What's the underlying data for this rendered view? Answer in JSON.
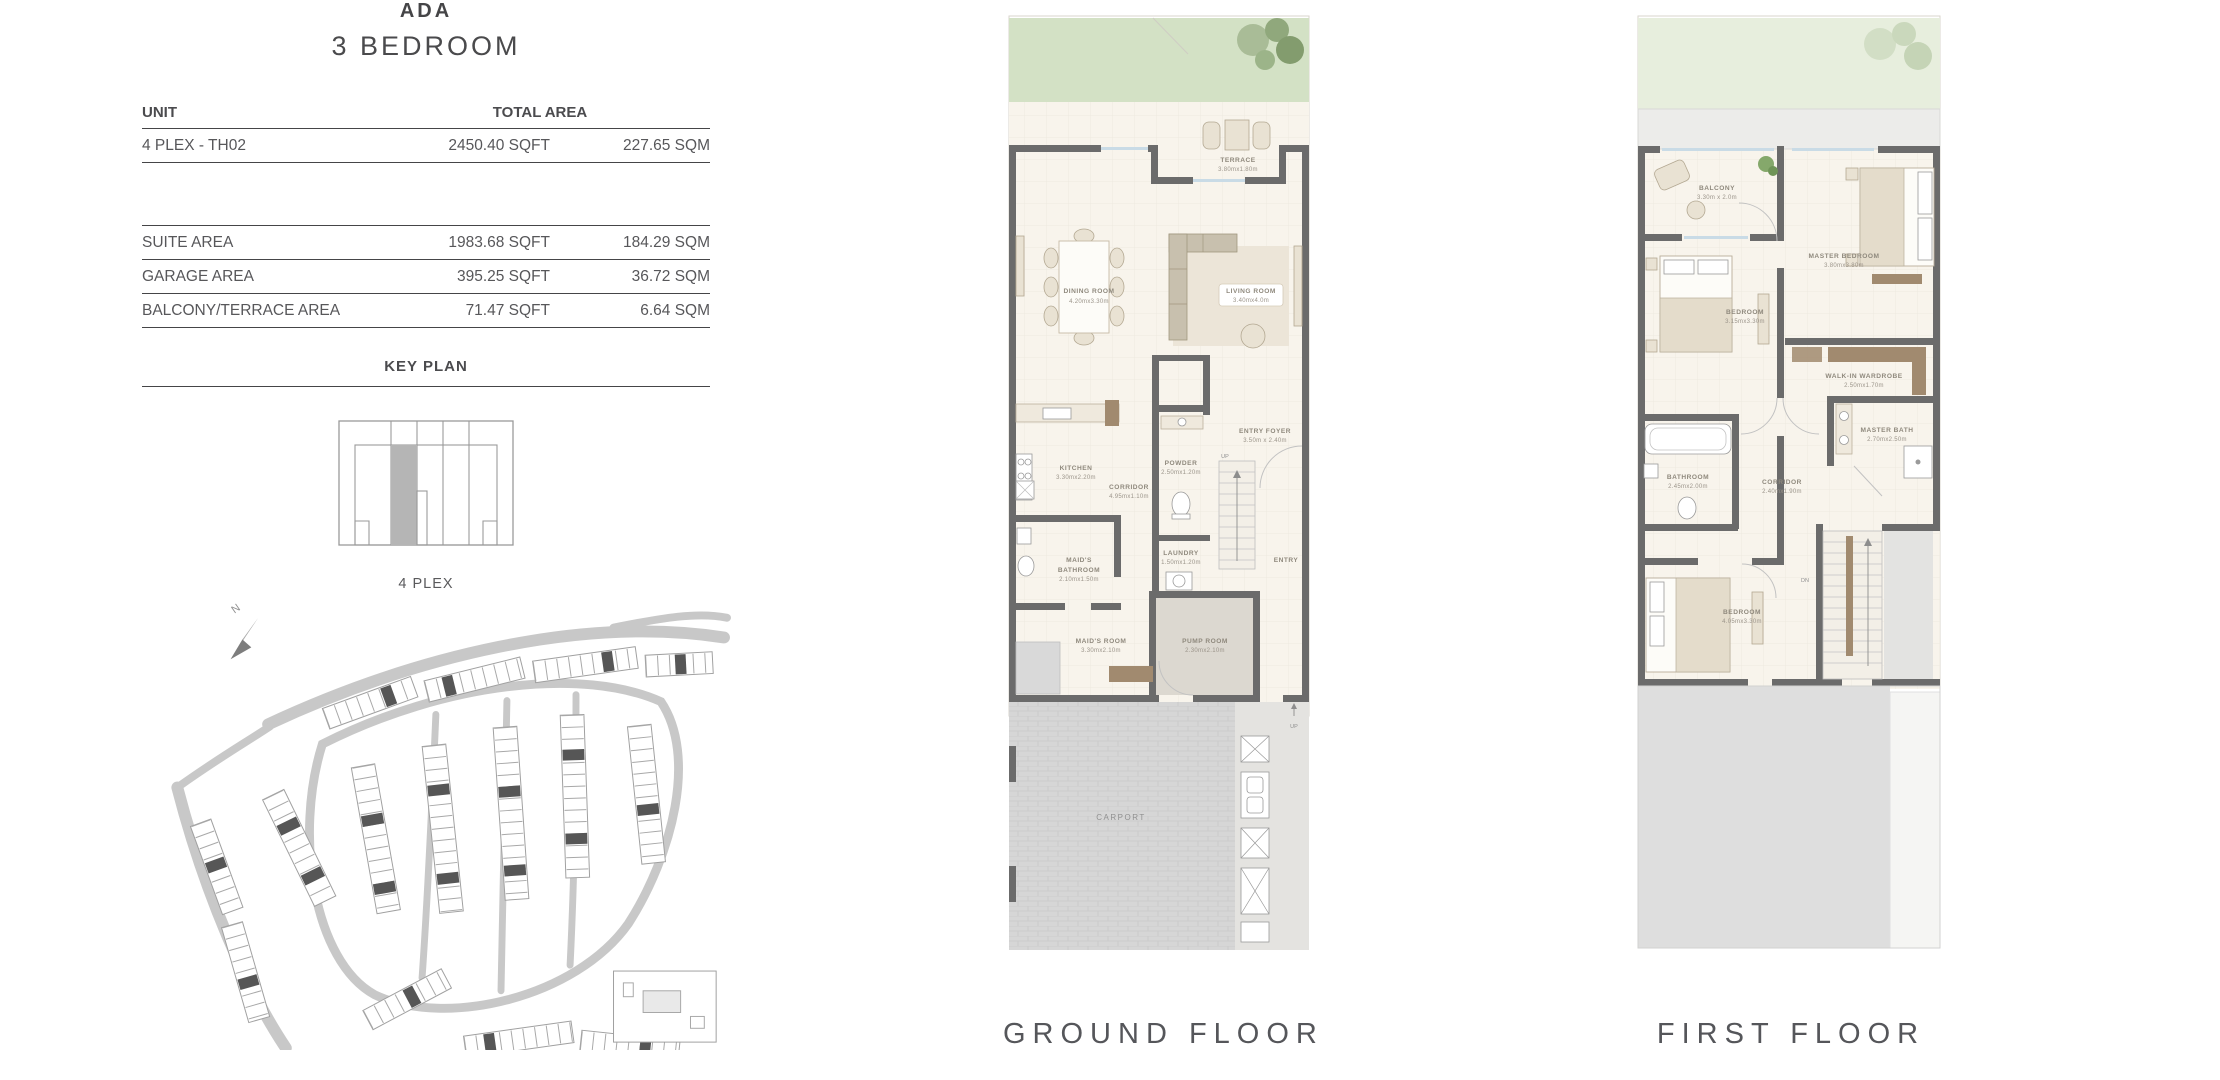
{
  "header": {
    "project": "ADA",
    "unit_type": "3 BEDROOM"
  },
  "area_table": {
    "unit_header": "UNIT",
    "total_area_header": "TOTAL AREA",
    "unit_row": {
      "label": "4 PLEX - TH02",
      "sqft": "2450.40 SQFT",
      "sqm": "227.65 SQM"
    },
    "rows": [
      {
        "label": "SUITE AREA",
        "sqft": "1983.68 SQFT",
        "sqm": "184.29 SQM"
      },
      {
        "label": "GARAGE AREA",
        "sqft": "395.25 SQFT",
        "sqm": "36.72 SQM"
      },
      {
        "label": "BALCONY/TERRACE AREA",
        "sqft": "71.47 SQFT",
        "sqm": "6.64 SQM"
      }
    ]
  },
  "key_plan": {
    "heading": "KEY PLAN",
    "caption": "4 PLEX"
  },
  "compass_label": "N",
  "floors": {
    "ground": {
      "label": "GROUND FLOOR",
      "stairs_up_label": "UP",
      "carport_up_label": "UP",
      "rooms": {
        "terrace": {
          "name": "TERRACE",
          "dims": "3.80mx1.80m"
        },
        "dining_room": {
          "name": "DINING ROOM",
          "dims": "4.20mx3.30m"
        },
        "living_room": {
          "name": "LIVING ROOM",
          "dims": "3.40mx4.0m"
        },
        "kitchen": {
          "name": "KITCHEN",
          "dims": "3.30mx2.20m"
        },
        "corridor": {
          "name": "CORRIDOR",
          "dims": "4.95mx1.10m"
        },
        "powder": {
          "name": "POWDER",
          "dims": "2.50mx1.20m"
        },
        "entry_foyer": {
          "name": "ENTRY FOYER",
          "dims": "3.50m x 2.40m"
        },
        "laundry": {
          "name": "LAUNDRY",
          "dims": "1.50mx1.20m"
        },
        "maids_bathroom": {
          "line1": "MAID'S",
          "line2": "BATHROOM",
          "dims": "2.10mx1.50m"
        },
        "maids_room": {
          "name": "MAID'S ROOM",
          "dims": "3.30mx2.10m"
        },
        "pump_room": {
          "name": "PUMP ROOM",
          "dims": "2.30mx2.10m"
        },
        "entry": {
          "name": "ENTRY"
        },
        "carport": {
          "name": "CARPORT"
        }
      }
    },
    "first": {
      "label": "FIRST FLOOR",
      "stairs_dn_label": "DN",
      "rooms": {
        "balcony": {
          "name": "BALCONY",
          "dims": "3.30m x 2.0m"
        },
        "master_bedroom": {
          "name": "MASTER BEDROOM",
          "dims": "3.80mx3.80m"
        },
        "bedroom_front": {
          "name": "BEDROOM",
          "dims": "3.15mx3.30m"
        },
        "walk_in_wardrobe": {
          "name": "WALK-IN WARDROBE",
          "dims": "2.50mx1.70m"
        },
        "master_bath": {
          "name": "MASTER BATH",
          "dims": "2.70mx2.50m"
        },
        "bathroom": {
          "name": "BATHROOM",
          "dims": "2.45mx2.00m"
        },
        "corridor": {
          "name": "CORRIDOR",
          "dims": "2.40mx1.90m"
        },
        "bedroom_back": {
          "name": "BEDROOM",
          "dims": "4.05mx3.30m"
        }
      }
    }
  },
  "colors": {
    "wall-color": "#6b6b6b",
    "floor-color": "#f8f4ec",
    "garden-color": "#d3e1c5",
    "garden-color-light": "#e7eedd",
    "carport-color": "#d6d6d6",
    "wood-color": "#a18a6f",
    "text-dark": "#4c4c4e",
    "map-gray": "#c8c8c8",
    "map-dark": "#565656",
    "highlight-gray": "#b5b5b5"
  }
}
